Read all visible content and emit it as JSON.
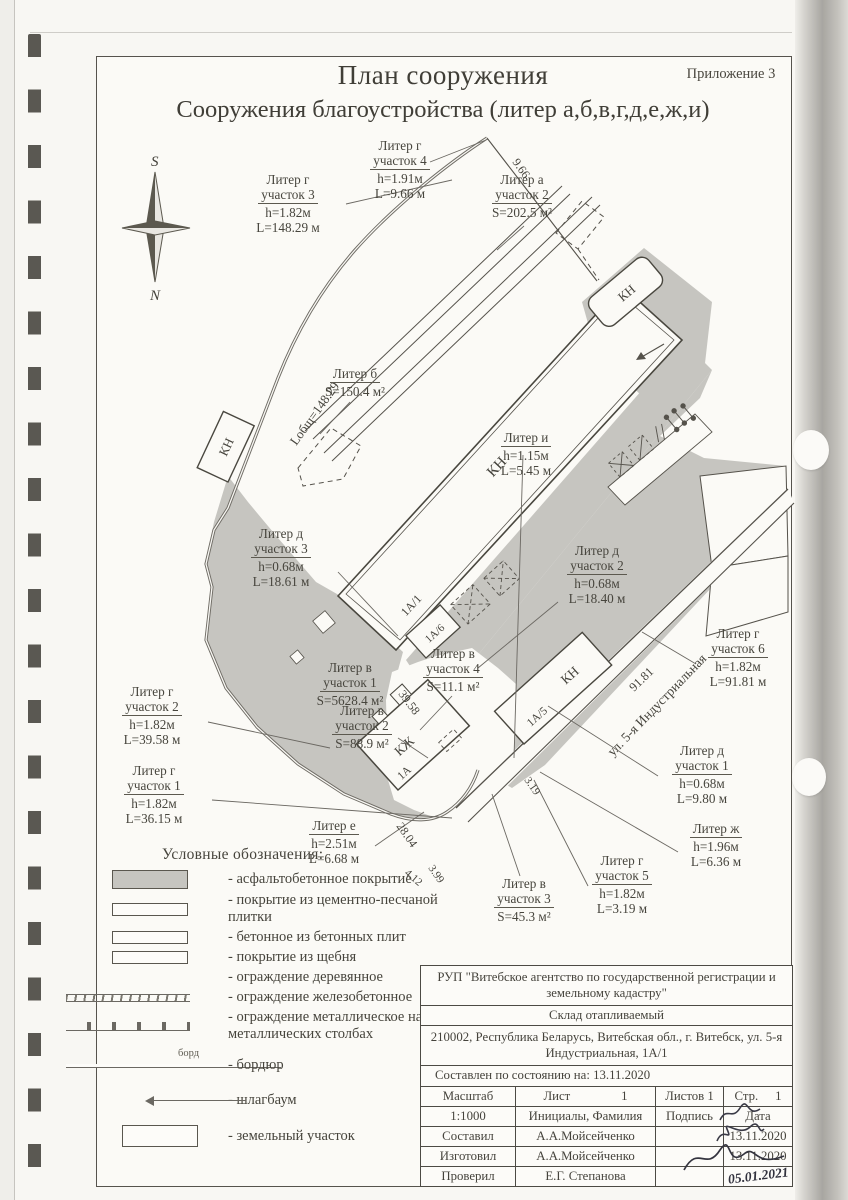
{
  "page": {
    "appendix": "Приложение 3",
    "title1": "План сооружения",
    "title2": "Сооружения  благоустройства (литер а,б,в,г,д,е,ж,и)"
  },
  "compass": {
    "s": "S",
    "n": "N"
  },
  "plan": {
    "street": "ул. 5-я Индустриальная",
    "marks": {
      "kn": "КН",
      "kzh": "КЖ",
      "a1": "1А/1",
      "a5": "1А/5",
      "a6": "1А/6",
      "a": "1А"
    },
    "dims": {
      "d966": "9.66",
      "ltot": "Lобщ=148.29",
      "d3958": "39.58",
      "d2804": "28.04",
      "d412": "4.12",
      "d399": "3.99",
      "d319": "3.19",
      "d9181": "91.81"
    },
    "labels": {
      "g4": {
        "n1": "Литер г",
        "n2": "участок 4",
        "v1": "h=1.91м",
        "v2": "L=9.66 м"
      },
      "g3": {
        "n1": "Литер г",
        "n2": "участок 3",
        "v1": "h=1.82м",
        "v2": "L=148.29 м"
      },
      "a2": {
        "n1": "Литер а",
        "n2": "участок 2",
        "v1": "S=202.5 м²"
      },
      "b": {
        "n1": "Литер б",
        "v1": "S=150.4 м²"
      },
      "i": {
        "n1": "Литер и",
        "v1": "h=1.15м",
        "v2": "L=5.45 м"
      },
      "d3": {
        "n1": "Литер д",
        "n2": "участок 3",
        "v1": "h=0.68м",
        "v2": "L=18.61 м"
      },
      "d2": {
        "n1": "Литер д",
        "n2": "участок 2",
        "v1": "h=0.68м",
        "v2": "L=18.40 м"
      },
      "g6": {
        "n1": "Литер г",
        "n2": "участок 6",
        "v1": "h=1.82м",
        "v2": "L=91.81 м"
      },
      "v1": {
        "n1": "Литер в",
        "n2": "участок 1",
        "v1": "S=5628.4 м²"
      },
      "v4": {
        "n1": "Литер в",
        "n2": "участок 4",
        "v1": "S=11.1 м²"
      },
      "g2": {
        "n1": "Литер г",
        "n2": "участок 2",
        "v1": "h=1.82м",
        "v2": "L=39.58 м"
      },
      "v2": {
        "n1": "Литер в",
        "n2": "участок 2",
        "v1": "S=88.9 м²"
      },
      "g1": {
        "n1": "Литер г",
        "n2": "участок 1",
        "v1": "h=1.82м",
        "v2": "L=36.15 м"
      },
      "e": {
        "n1": "Литер е",
        "v1": "h=2.51м",
        "v2": "L=6.68 м"
      },
      "d1": {
        "n1": "Литер д",
        "n2": "участок 1",
        "v1": "h=0.68м",
        "v2": "L=9.80 м"
      },
      "zh": {
        "n1": "Литер ж",
        "v1": "h=1.96м",
        "v2": "L=6.36 м"
      },
      "g5": {
        "n1": "Литер г",
        "n2": "участок 5",
        "v1": "h=1.82м",
        "v2": "L=3.19 м"
      },
      "v3": {
        "n1": "Литер в",
        "n2": "участок 3",
        "v1": "S=45.3 м²"
      }
    }
  },
  "legend": {
    "title": "Условные обозначения:",
    "bord": "борд",
    "items": [
      {
        "label": "- асфальтобетонное  покрытие"
      },
      {
        "label": "- покрытие из цементно-песчаной плитки"
      },
      {
        "label": "- бетонное из бетонных плит"
      },
      {
        "label": "- покрытие из щебня"
      },
      {
        "label": "- ограждение деревянное"
      },
      {
        "label": "- ограждение железобетонное"
      },
      {
        "label": "- ограждение металлическое на металлических столбах"
      },
      {
        "label": "- бордюр"
      },
      {
        "label": "- шлагбаум"
      },
      {
        "label": "- земельный участок"
      }
    ]
  },
  "titleblock": {
    "org": "РУП \"Витебское агентство по государственной регистрации и земельному кадастру\"",
    "object": "Склад отапливаемый",
    "address": "210002, Республика Беларусь, Витебская обл., г. Витебск, ул. 5-я Индустриальная, 1А/1",
    "as_of": "Составлен по состоянию на: 13.11.2020",
    "scale_label": "Масштаб",
    "sheet_label": "Лист",
    "sheet_num": "1",
    "sheets_label": "Листов 1",
    "page_label": "Стр.",
    "page_num": "1",
    "scale_value": "1:1000",
    "initials_label": "Инициалы, Фамилия",
    "sign_label": "Подпись",
    "date_label": "Дата",
    "rows": [
      {
        "role": "Составил",
        "person": "А.А.Мойсейченко",
        "date": "13.11.2020"
      },
      {
        "role": "Изготовил",
        "person": "А.А.Мойсейченко",
        "date": "13.11.2020"
      },
      {
        "role": "Проверил",
        "person": "Е.Г. Степанова",
        "date": "05.01.2021"
      }
    ]
  }
}
